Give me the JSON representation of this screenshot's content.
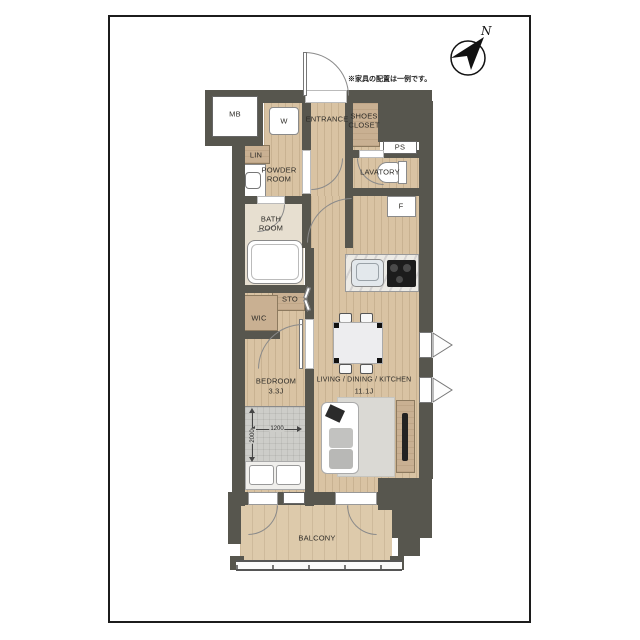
{
  "annotations": {
    "note": "※家具の配置は一例です。",
    "compass_north": "N"
  },
  "rooms": {
    "mb": "MB",
    "w": "W",
    "entrance": "ENTRANCE",
    "shoes_closet_line1": "SHOES",
    "shoes_closet_line2": "CLOSET",
    "ps": "PS",
    "lin": "LIN",
    "powder_line1": "POWDER",
    "powder_line2": "ROOM",
    "lavatory": "LAVATORY",
    "f": "F",
    "bath_line1": "BATH",
    "bath_line2": "ROOM",
    "sto": "STO",
    "wic": "WIC",
    "bedroom_label": "BEDROOM",
    "bedroom_size": "3.3J",
    "ldk_label": "LIVING / DINING / KITCHEN",
    "ldk_size": "11.1J",
    "balcony": "BALCONY"
  },
  "bed_dimensions": {
    "width": "1200",
    "depth": "2000"
  },
  "colors": {
    "wall": "#57564e",
    "wood_floor": "#d9c3a3",
    "balcony_floor": "#ddcaab",
    "line": "#1c1c1c"
  }
}
